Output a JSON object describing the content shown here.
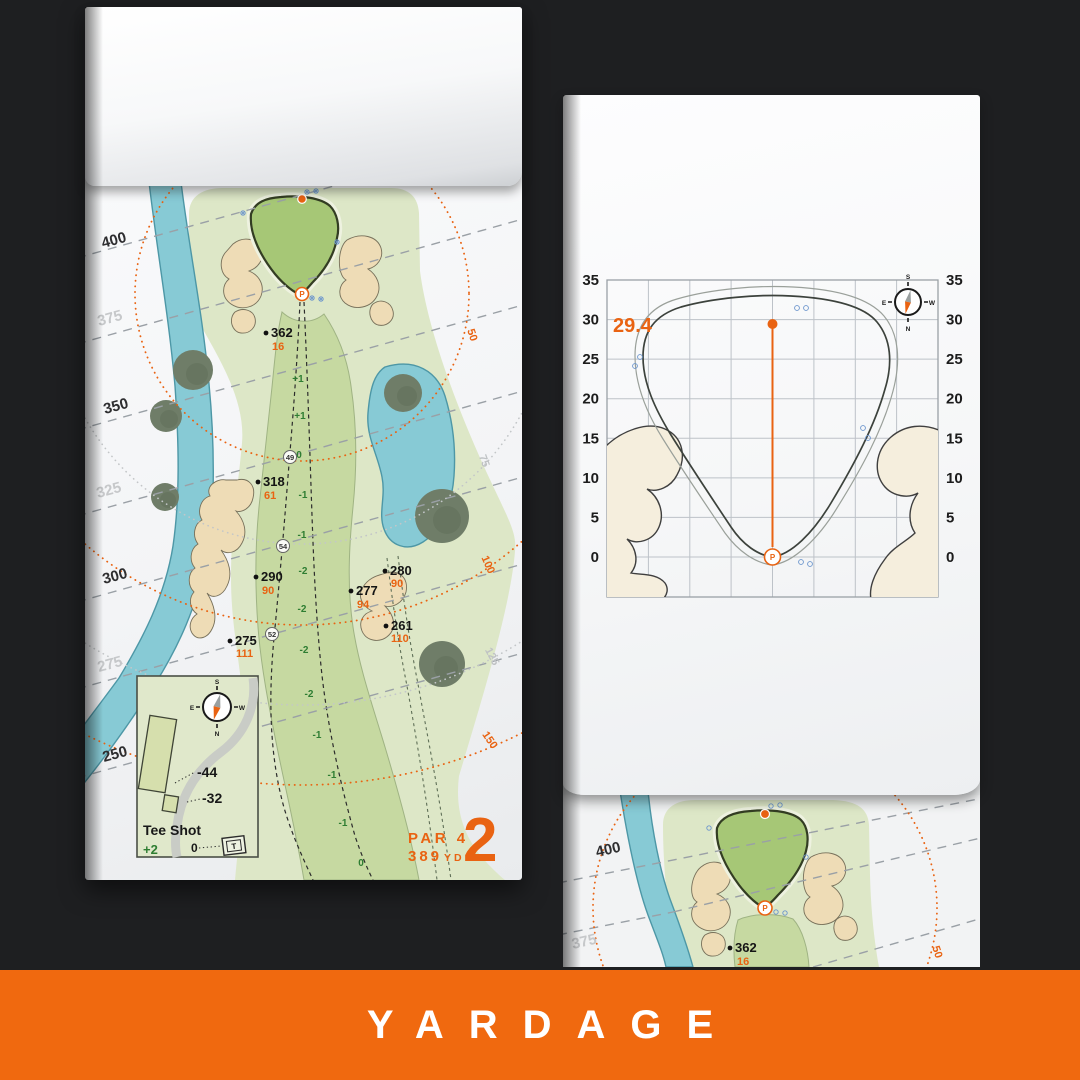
{
  "banner": {
    "label": "YARDAGE",
    "bg_color": "#f0690f"
  },
  "accent_color": "#e96312",
  "pin_label": "P",
  "hole": {
    "number": "2",
    "par_label": "PAR 4",
    "yardage_num": "389",
    "yardage_unit": "YD"
  },
  "left_page": {
    "margin_labels": [
      "400",
      "375",
      "350",
      "325",
      "300",
      "275",
      "250"
    ],
    "arc_labels": [
      "50",
      "75",
      "100",
      "125",
      "150"
    ],
    "points": [
      {
        "name": "362",
        "sub": "16"
      },
      {
        "name": "318",
        "sub": "61"
      },
      {
        "name": "290",
        "sub": "90"
      },
      {
        "name": "280",
        "sub": "90"
      },
      {
        "name": "277",
        "sub": "94"
      },
      {
        "name": "261",
        "sub": "110"
      },
      {
        "name": "275",
        "sub": "111"
      }
    ],
    "slope_numbers": [
      "+1",
      "+1",
      "0",
      "-1",
      "-1",
      "-2",
      "-2",
      "-2",
      "-2",
      "-1",
      "-1",
      "-1",
      "0"
    ],
    "circled_numbers": [
      "49",
      "54",
      "52"
    ],
    "tee_inset": {
      "title": "Tee Shot",
      "score": "+2",
      "zero_label": "0",
      "tee_marker": "T",
      "offset_a": "-44",
      "offset_b": "-32"
    },
    "compass": {
      "n": "N",
      "s": "S",
      "e": "E",
      "w": "W"
    }
  },
  "chart": {
    "pin_value": "29.4",
    "y_ticks": [
      "35",
      "30",
      "25",
      "20",
      "15",
      "10",
      "5",
      "0"
    ],
    "compass": {
      "n": "N",
      "s": "S",
      "e": "E",
      "w": "W"
    }
  },
  "next_page": {
    "margin_labels": [
      "400",
      "375"
    ],
    "arc_label": "50",
    "point": {
      "name": "362",
      "sub": "16"
    }
  }
}
